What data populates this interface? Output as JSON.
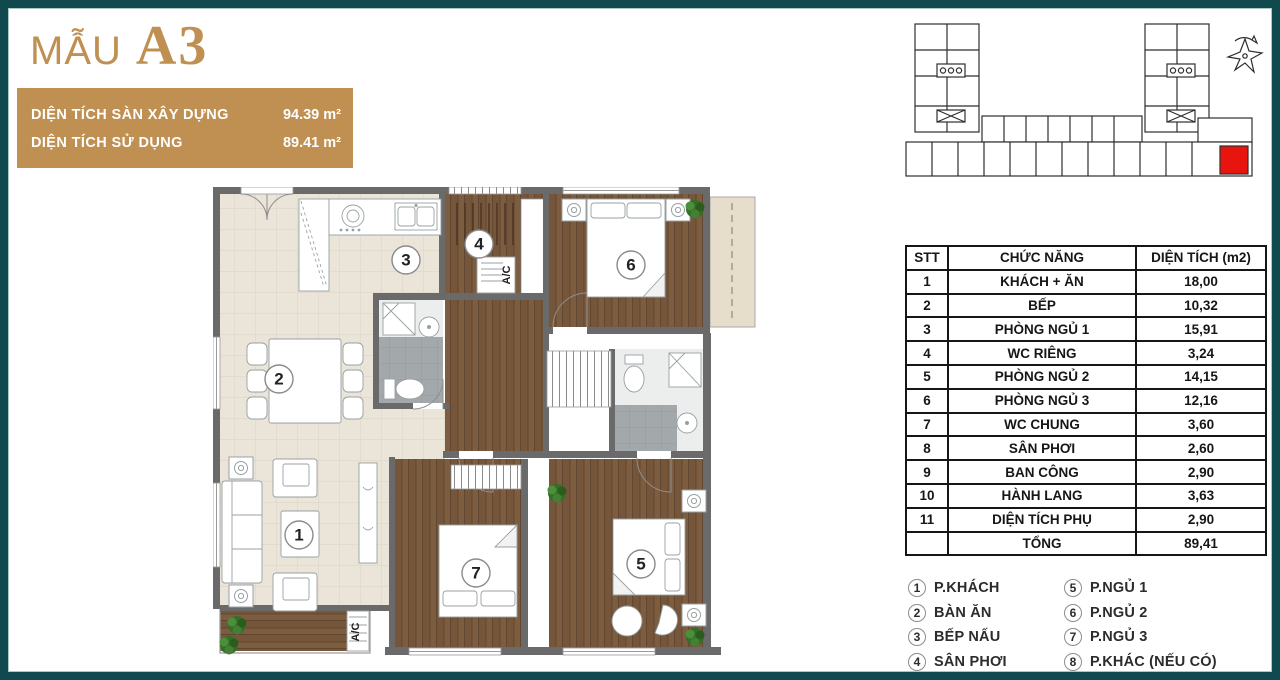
{
  "title": {
    "prefix": "MẪU",
    "model": "A3"
  },
  "area_panel": {
    "rows": [
      {
        "label": "DIỆN TÍCH SÀN XÂY DỰNG",
        "value": "94.39 m²"
      },
      {
        "label": "DIỆN TÍCH SỬ DỤNG",
        "value": "89.41 m²"
      }
    ]
  },
  "plan": {
    "markers": [
      "1",
      "2",
      "3",
      "4",
      "5",
      "6",
      "7"
    ],
    "ac_label": "A/C"
  },
  "table": {
    "headers": [
      "STT",
      "CHỨC NĂNG",
      "DIỆN TÍCH (m2)"
    ],
    "rows": [
      [
        "1",
        "KHÁCH + ĂN",
        "18,00"
      ],
      [
        "2",
        "BẾP",
        "10,32"
      ],
      [
        "3",
        "PHÒNG NGỦ 1",
        "15,91"
      ],
      [
        "4",
        "WC RIÊNG",
        "3,24"
      ],
      [
        "5",
        "PHÒNG NGỦ 2",
        "14,15"
      ],
      [
        "6",
        "PHÒNG NGỦ 3",
        "12,16"
      ],
      [
        "7",
        "WC CHUNG",
        "3,60"
      ],
      [
        "8",
        "SÂN PHƠI",
        "2,60"
      ],
      [
        "9",
        "BAN CÔNG",
        "2,90"
      ],
      [
        "10",
        "HÀNH LANG",
        "3,63"
      ],
      [
        "11",
        "DIỆN TÍCH PHỤ",
        "2,90"
      ]
    ],
    "total_label": "TỔNG",
    "total_value": "89,41"
  },
  "legend": {
    "items": [
      {
        "num": "1",
        "label": "P.KHÁCH"
      },
      {
        "num": "2",
        "label": "BÀN ĂN"
      },
      {
        "num": "3",
        "label": "BẾP NẤU"
      },
      {
        "num": "4",
        "label": "SÂN PHƠI"
      },
      {
        "num": "5",
        "label": "P.NGỦ 1"
      },
      {
        "num": "6",
        "label": "P.NGỦ 2"
      },
      {
        "num": "7",
        "label": "P.NGỦ 3"
      },
      {
        "num": "8",
        "label": "P.KHÁC (NẾU CÓ)"
      }
    ]
  },
  "colors": {
    "frame_teal": "#114a4e",
    "gold": "#bf9051",
    "highlight_red": "#e8150e",
    "wall_gray": "#6a6a6a",
    "wood": "#7d5d40",
    "tile_beige": "#eae4d9"
  }
}
